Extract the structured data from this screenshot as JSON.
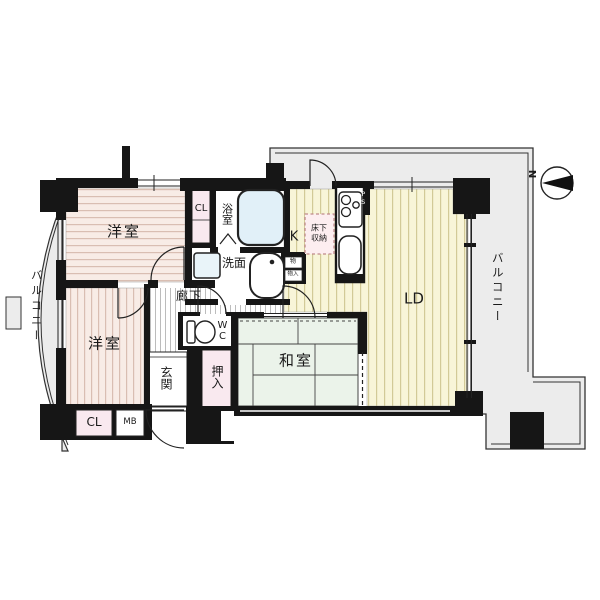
{
  "plan": {
    "rooms": {
      "bedroom_top": "洋室",
      "bedroom_bottom": "洋室",
      "japanese_room": "和室",
      "living_dining": "LD",
      "kitchen": "K",
      "bath": "浴室",
      "washroom": "洗面",
      "toilet": "WC",
      "hallway": "廊下",
      "entrance": "玄関",
      "oshiire": "押入",
      "closet_top": "CL",
      "closet_bottom": "CL",
      "meter_box": "MB",
      "pipe_space": "PS",
      "underfloor_storage_line1": "床下",
      "underfloor_storage_line2": "収納",
      "storage_top": "物",
      "storage_bottom": "物入"
    },
    "balcony_left": "バルコニー",
    "balcony_right": "バルコニー",
    "compass_label": "N",
    "colors": {
      "wall": "#161616",
      "bedroom_floor": "#f8ece6",
      "bedroom_stripe": "#d9beb2",
      "wood_floor": "#f8f5d8",
      "wood_stripe": "#d2ca97",
      "tatami": "#ebf3ea",
      "closet_pink": "#f9e9ef",
      "balcony": "#ececec",
      "tub_blue": "#e1f0f8"
    }
  }
}
